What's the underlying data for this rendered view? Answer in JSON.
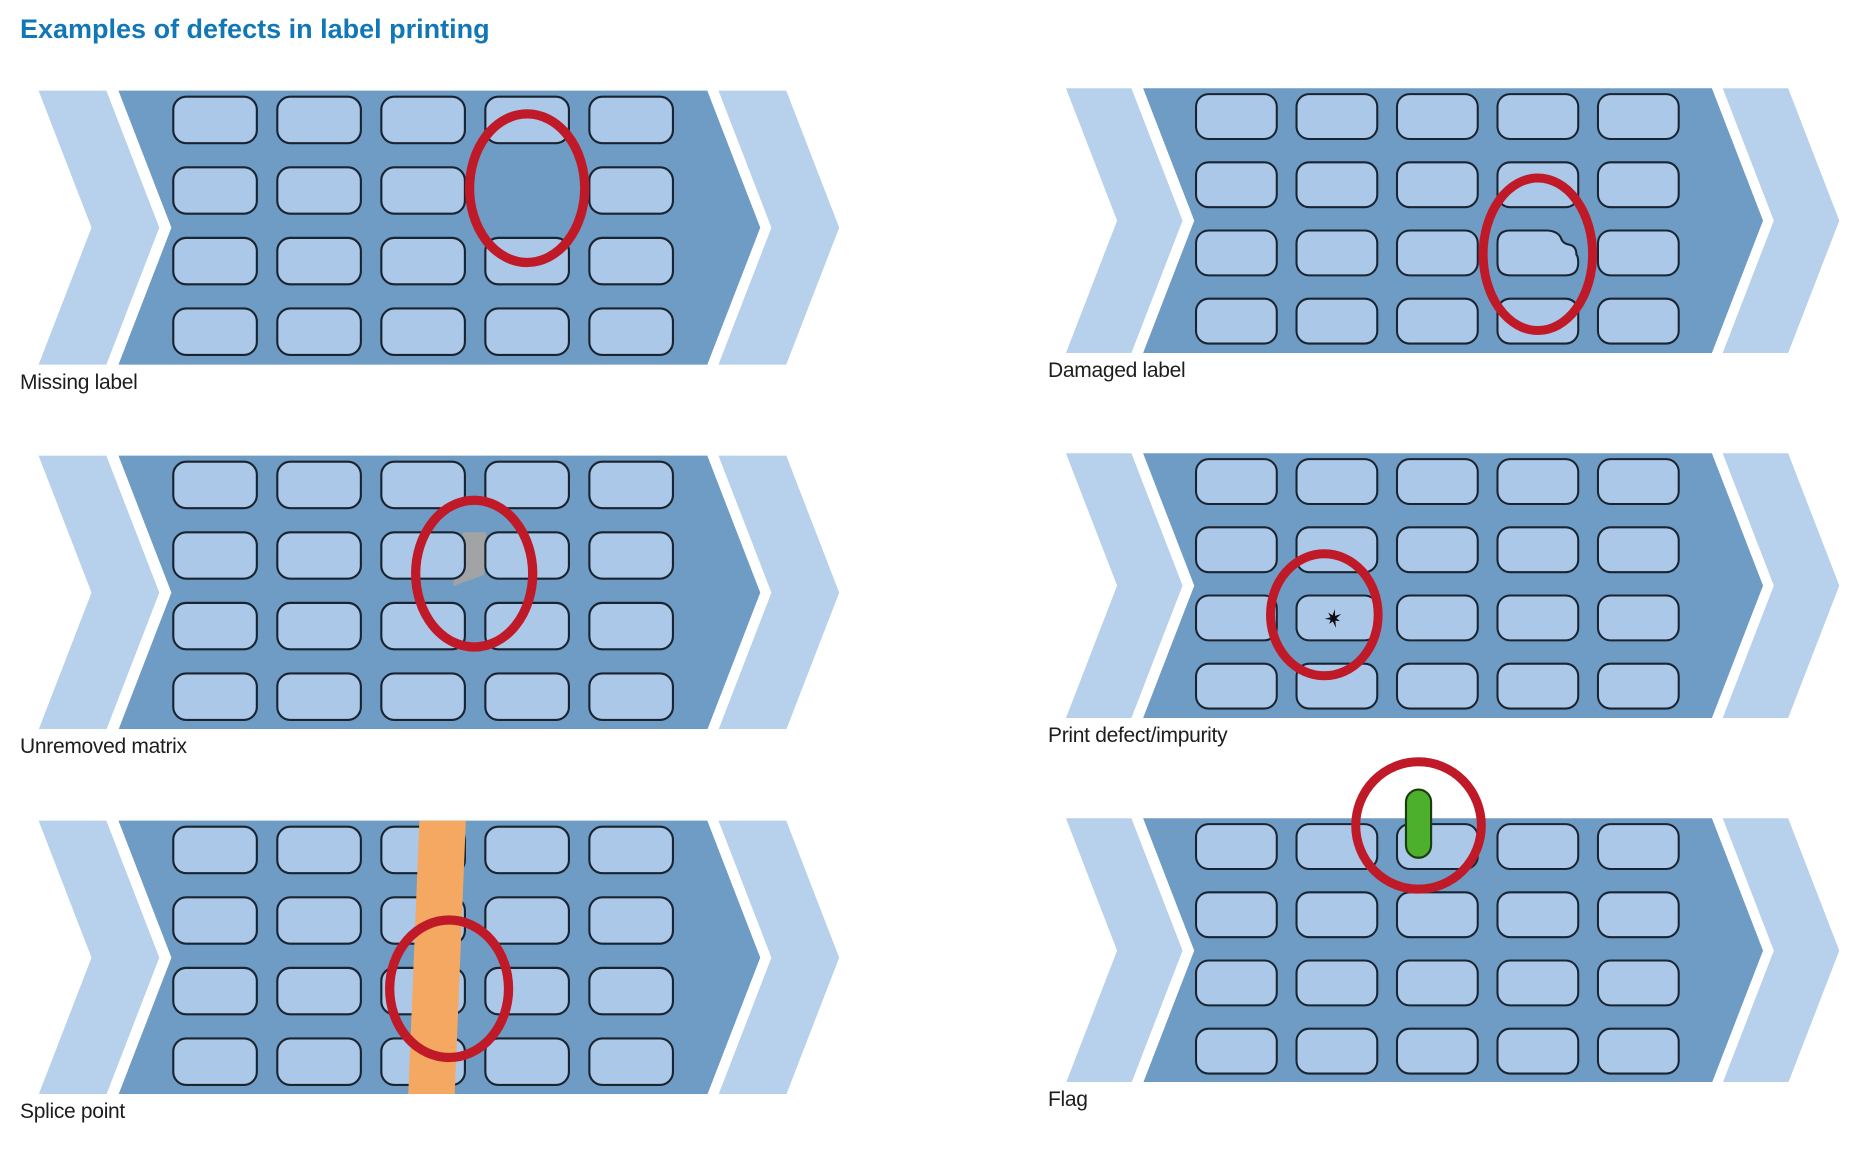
{
  "title": "Examples of defects in label printing",
  "colors": {
    "title": "#1277b6",
    "caption": "#1d1d1b",
    "web_band": "#6f9cc4",
    "chevron": "#b7d1ec",
    "label_fill": "#abc8e9",
    "label_outline": "#1a2430",
    "highlight_circle": "#c01a28",
    "splice_tape": "#f4a862",
    "flag_marker": "#4db02c",
    "flag_outline": "#1d3b10",
    "matrix_gray": "#a2a3a4",
    "speck": "#0e0e12"
  },
  "web": {
    "rows": 4,
    "cols": 5
  },
  "panels": [
    {
      "caption": "Missing label",
      "defect_type": "missing_label",
      "missing_cell": {
        "row": 2,
        "col": 4
      },
      "circle": {
        "cx": 546,
        "cy": 105,
        "rx": 62,
        "ry": 80
      }
    },
    {
      "caption": "Damaged label",
      "defect_type": "damaged_label",
      "damaged_cell": {
        "row": 3,
        "col": 4
      },
      "circle": {
        "cx": 546,
        "cy": 185,
        "rx": 61,
        "ry": 85
      }
    },
    {
      "caption": "Unremoved matrix",
      "defect_type": "unremoved_matrix",
      "matrix_gap": {
        "row": 2,
        "after_col": 3
      },
      "circle": {
        "cx": 489,
        "cy": 127,
        "rx": 63,
        "ry": 79
      }
    },
    {
      "caption": "Print defect/impurity",
      "defect_type": "print_defect",
      "speck": {
        "cx": 318,
        "cy": 184,
        "r": 10
      },
      "circle": {
        "cx": 308,
        "cy": 180,
        "rx": 60,
        "ry": 68
      }
    },
    {
      "caption": "Splice point",
      "defect_type": "splice_point",
      "stripe": {
        "x_top": 430,
        "x_bottom": 418,
        "width": 50
      },
      "circle": {
        "cx": 462,
        "cy": 181,
        "rx": 64,
        "ry": 74
      }
    },
    {
      "caption": "Flag",
      "defect_type": "flag",
      "flag": {
        "x": 399,
        "y": -32,
        "width": 28,
        "height": 76
      },
      "circle": {
        "cx": 413,
        "cy": 8,
        "rx": 70,
        "ry": 71
      }
    }
  ]
}
